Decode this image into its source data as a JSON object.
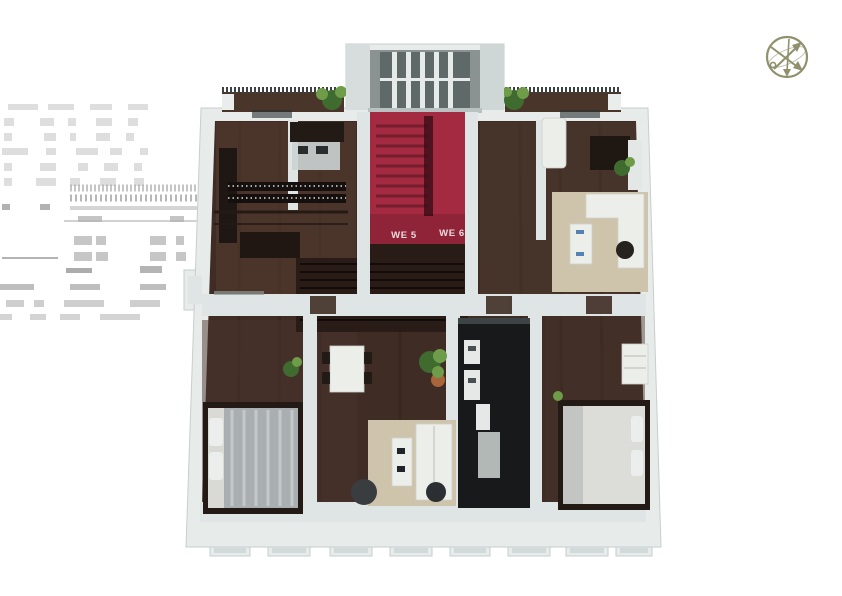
{
  "scene": {
    "description": "3D cutaway floor plan rendering of one apartment storey, viewed from above, on a plain white background",
    "background_color": "#ffffff",
    "ghost_annotation": {
      "present": true,
      "legible": false
    }
  },
  "compass": {
    "icon": "compass-icon"
  },
  "plan": {
    "unit_labels": [
      {
        "text": "WE 5"
      },
      {
        "text": "WE 6"
      }
    ],
    "colors": {
      "wall": "#e7ebea",
      "wall_edge": "#c6cfce",
      "wall_inner": "#dfe5e4",
      "wood": "#3f2d25",
      "wood_dark": "#291c16",
      "stair_red": "#a32a40",
      "stair_red_dark": "#6f1b2b",
      "kitchen_black": "#17191b",
      "rug": "#cec4ac",
      "white_furniture": "#eceeea",
      "plant": "#3f6b2f",
      "plant_light": "#6f9c49",
      "ghost": "#d9d9d9",
      "railing": "#3c4241",
      "unit_label": "#ecdadd",
      "compass": "#84855e"
    }
  }
}
